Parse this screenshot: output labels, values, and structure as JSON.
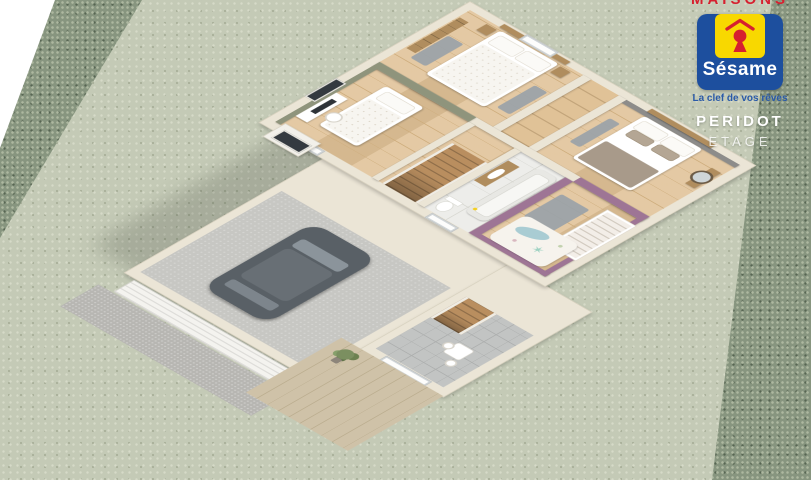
{
  "branding": {
    "top_clipped_text": "MAISONS",
    "logo_text": "Sésame",
    "tagline": "La clef de vos rêves",
    "program_name": "PERIDOT",
    "floor_label": "ETAGE"
  },
  "palette": {
    "grass": "#c4cab6",
    "grass_dot": "#d6dac8",
    "hedge": "#87957f",
    "hedge_dot": "#adb8a0",
    "cream": "#ebe5d6",
    "cream_edge": "#d6cfbc",
    "wood": "#e0c297",
    "wood_line": "#cead7d",
    "wood_dark": "#b08d5e",
    "tile": "#ededea",
    "tile_line": "#d8d8d2",
    "gray_tile": "#c2c4c3",
    "gray_tile_line": "#adafae",
    "concrete": "#c7c7c3",
    "green_wall": "#8f947c",
    "gray_wall": "#8d8c8a",
    "purple_wall": "#9e7595",
    "car_body": "#596066",
    "deck": "#cfc2a8",
    "deck_line": "#bcae90",
    "driveway": "#b7b6b2",
    "stair_wood": "#b98e5f",
    "rug_gray": "#9aa2a8",
    "logo_blue": "#1d4f9e",
    "logo_yellow": "#f8d800",
    "logo_red": "#d6202f",
    "tagline_blue": "#2a5aa8"
  },
  "scene": {
    "view": "3d-cutaway-floor-plan",
    "upper_floor_rooms": [
      "master bedroom",
      "dressing",
      "gray-wall bedroom",
      "green-wall bedroom",
      "bathroom",
      "nursery",
      "landing with staircase"
    ],
    "ground_floor_rooms": [
      "garage with car",
      "entry hall",
      "wood terrace",
      "driveway"
    ],
    "garden": [
      "lawn",
      "hedge top-left",
      "hedge right"
    ]
  }
}
